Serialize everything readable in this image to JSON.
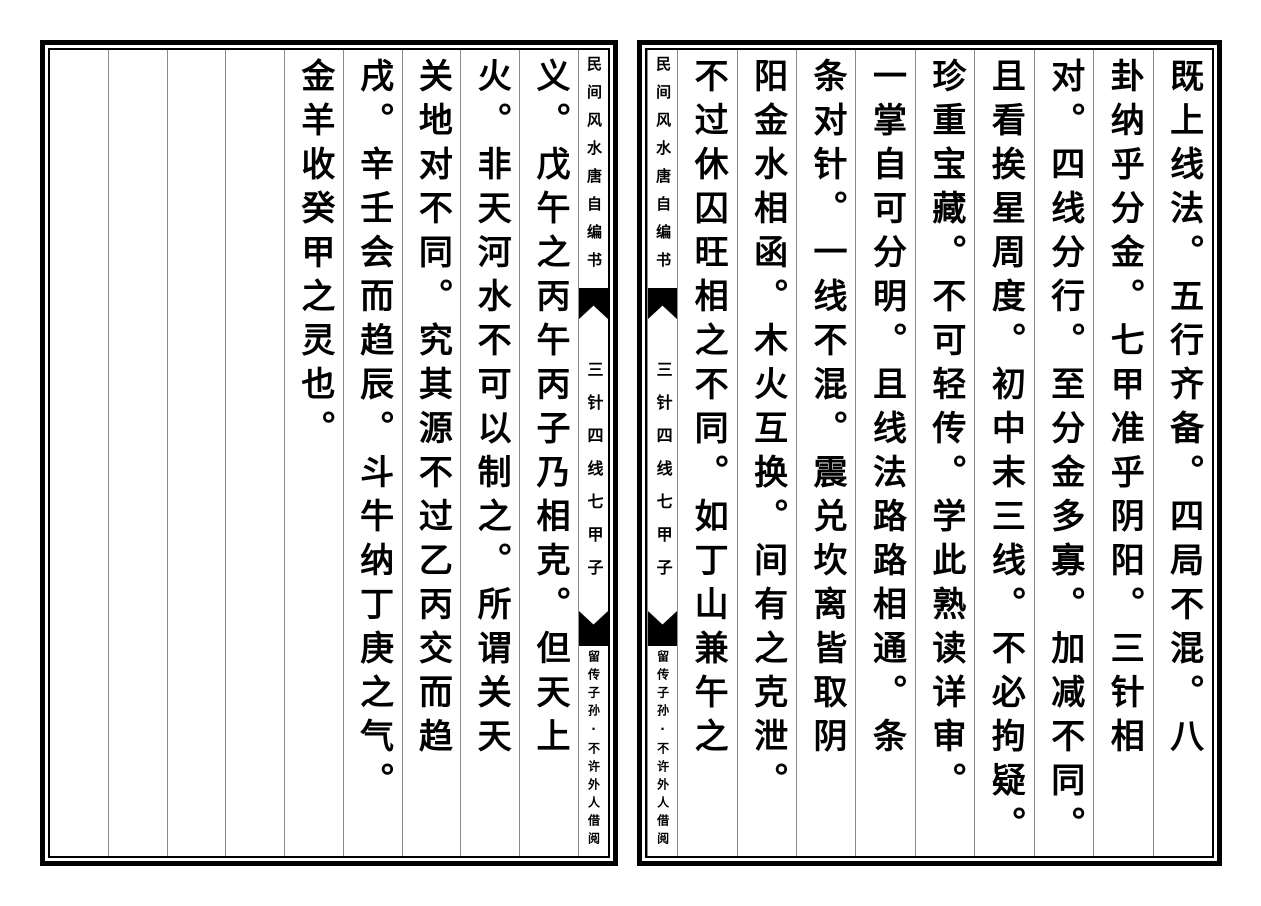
{
  "colors": {
    "ink": "#000000",
    "paper": "#ffffff",
    "divider": "#8a8a8a"
  },
  "spine": {
    "title": "民间风水唐自编书",
    "section": "三针四线七甲子",
    "note": "留传子孙·不许外人借阅"
  },
  "right_page": {
    "columns": [
      "既上线法。五行齐备。四局不混。八",
      "卦纳乎分金。七甲准乎阴阳。三针相",
      "对。四线分行。至分金多寡。加减不同。",
      "且看挨星周度。初中末三线。不必拘疑。",
      "珍重宝藏。不可轻传。学此熟读详审。",
      "一掌自可分明。且线法路路相通。条",
      "条对针。一线不混。震兑坎离皆取阴",
      "阳金水相函。木火互换。间有之克泄。",
      "不过休囚旺相之不同。如丁山兼午之"
    ]
  },
  "left_page": {
    "columns": [
      "义。戊午之丙午丙子乃相克。但天上",
      "火。非天河水不可以制之。所谓关天",
      "关地对不同。究其源不过乙丙交而趋",
      "戌。辛壬会而趋辰。斗牛纳丁庚之气。",
      "金羊收癸甲之灵也。"
    ],
    "empty_column_count": 4
  }
}
